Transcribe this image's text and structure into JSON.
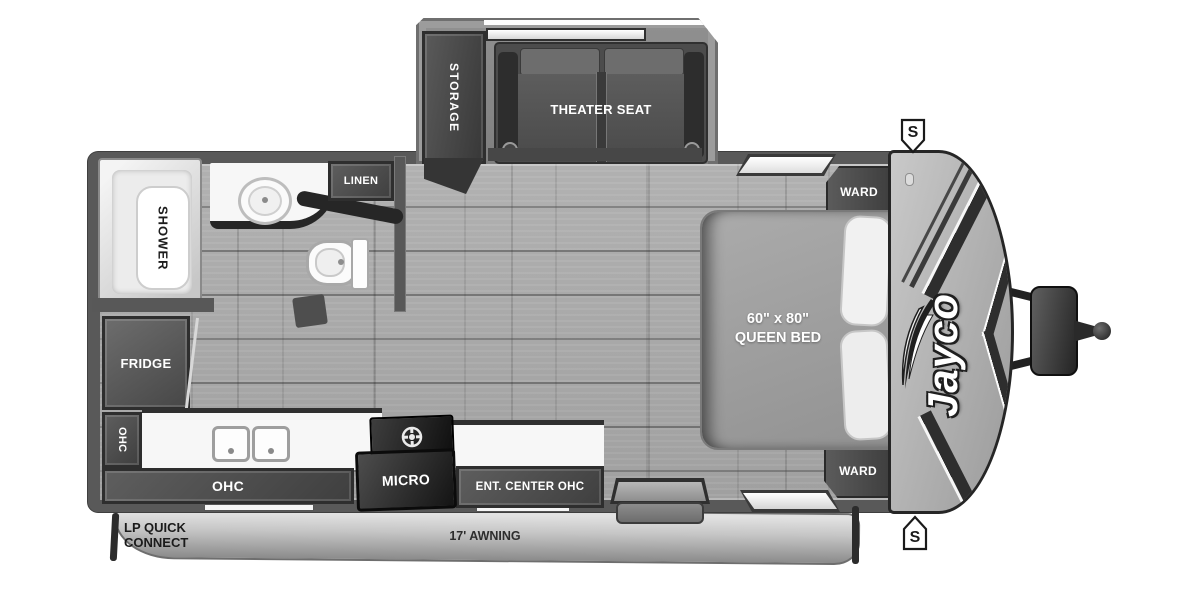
{
  "labels": {
    "storage": "STORAGE",
    "theater_seat": "THEATER SEAT",
    "linen": "LINEN",
    "shower": "SHOWER",
    "fridge": "FRIDGE",
    "ohc_upper": "OHC",
    "ohc_lower": "OHC",
    "micro": "MICRO",
    "ent_center_ohc": "ENT. CENTER OHC",
    "ward_front": "WARD",
    "ward_rear": "WARD",
    "bed_size": "60\" x 80\"",
    "bed_type": "QUEEN BED",
    "lp_quick_connect_line1": "LP QUICK",
    "lp_quick_connect_line2": "CONNECT",
    "awning": "17' AWNING",
    "brand_logo": "Jayco",
    "stabilizer_front": "S",
    "stabilizer_rear": "S"
  },
  "colors": {
    "wall": "#595959",
    "cabinet_dark": "#454545",
    "floor": "#a8a8a8",
    "fixture_white": "#f5f5f5",
    "front_cap": "#b5b5b5",
    "accent_black": "#2b2b2b",
    "background": "#ffffff"
  }
}
